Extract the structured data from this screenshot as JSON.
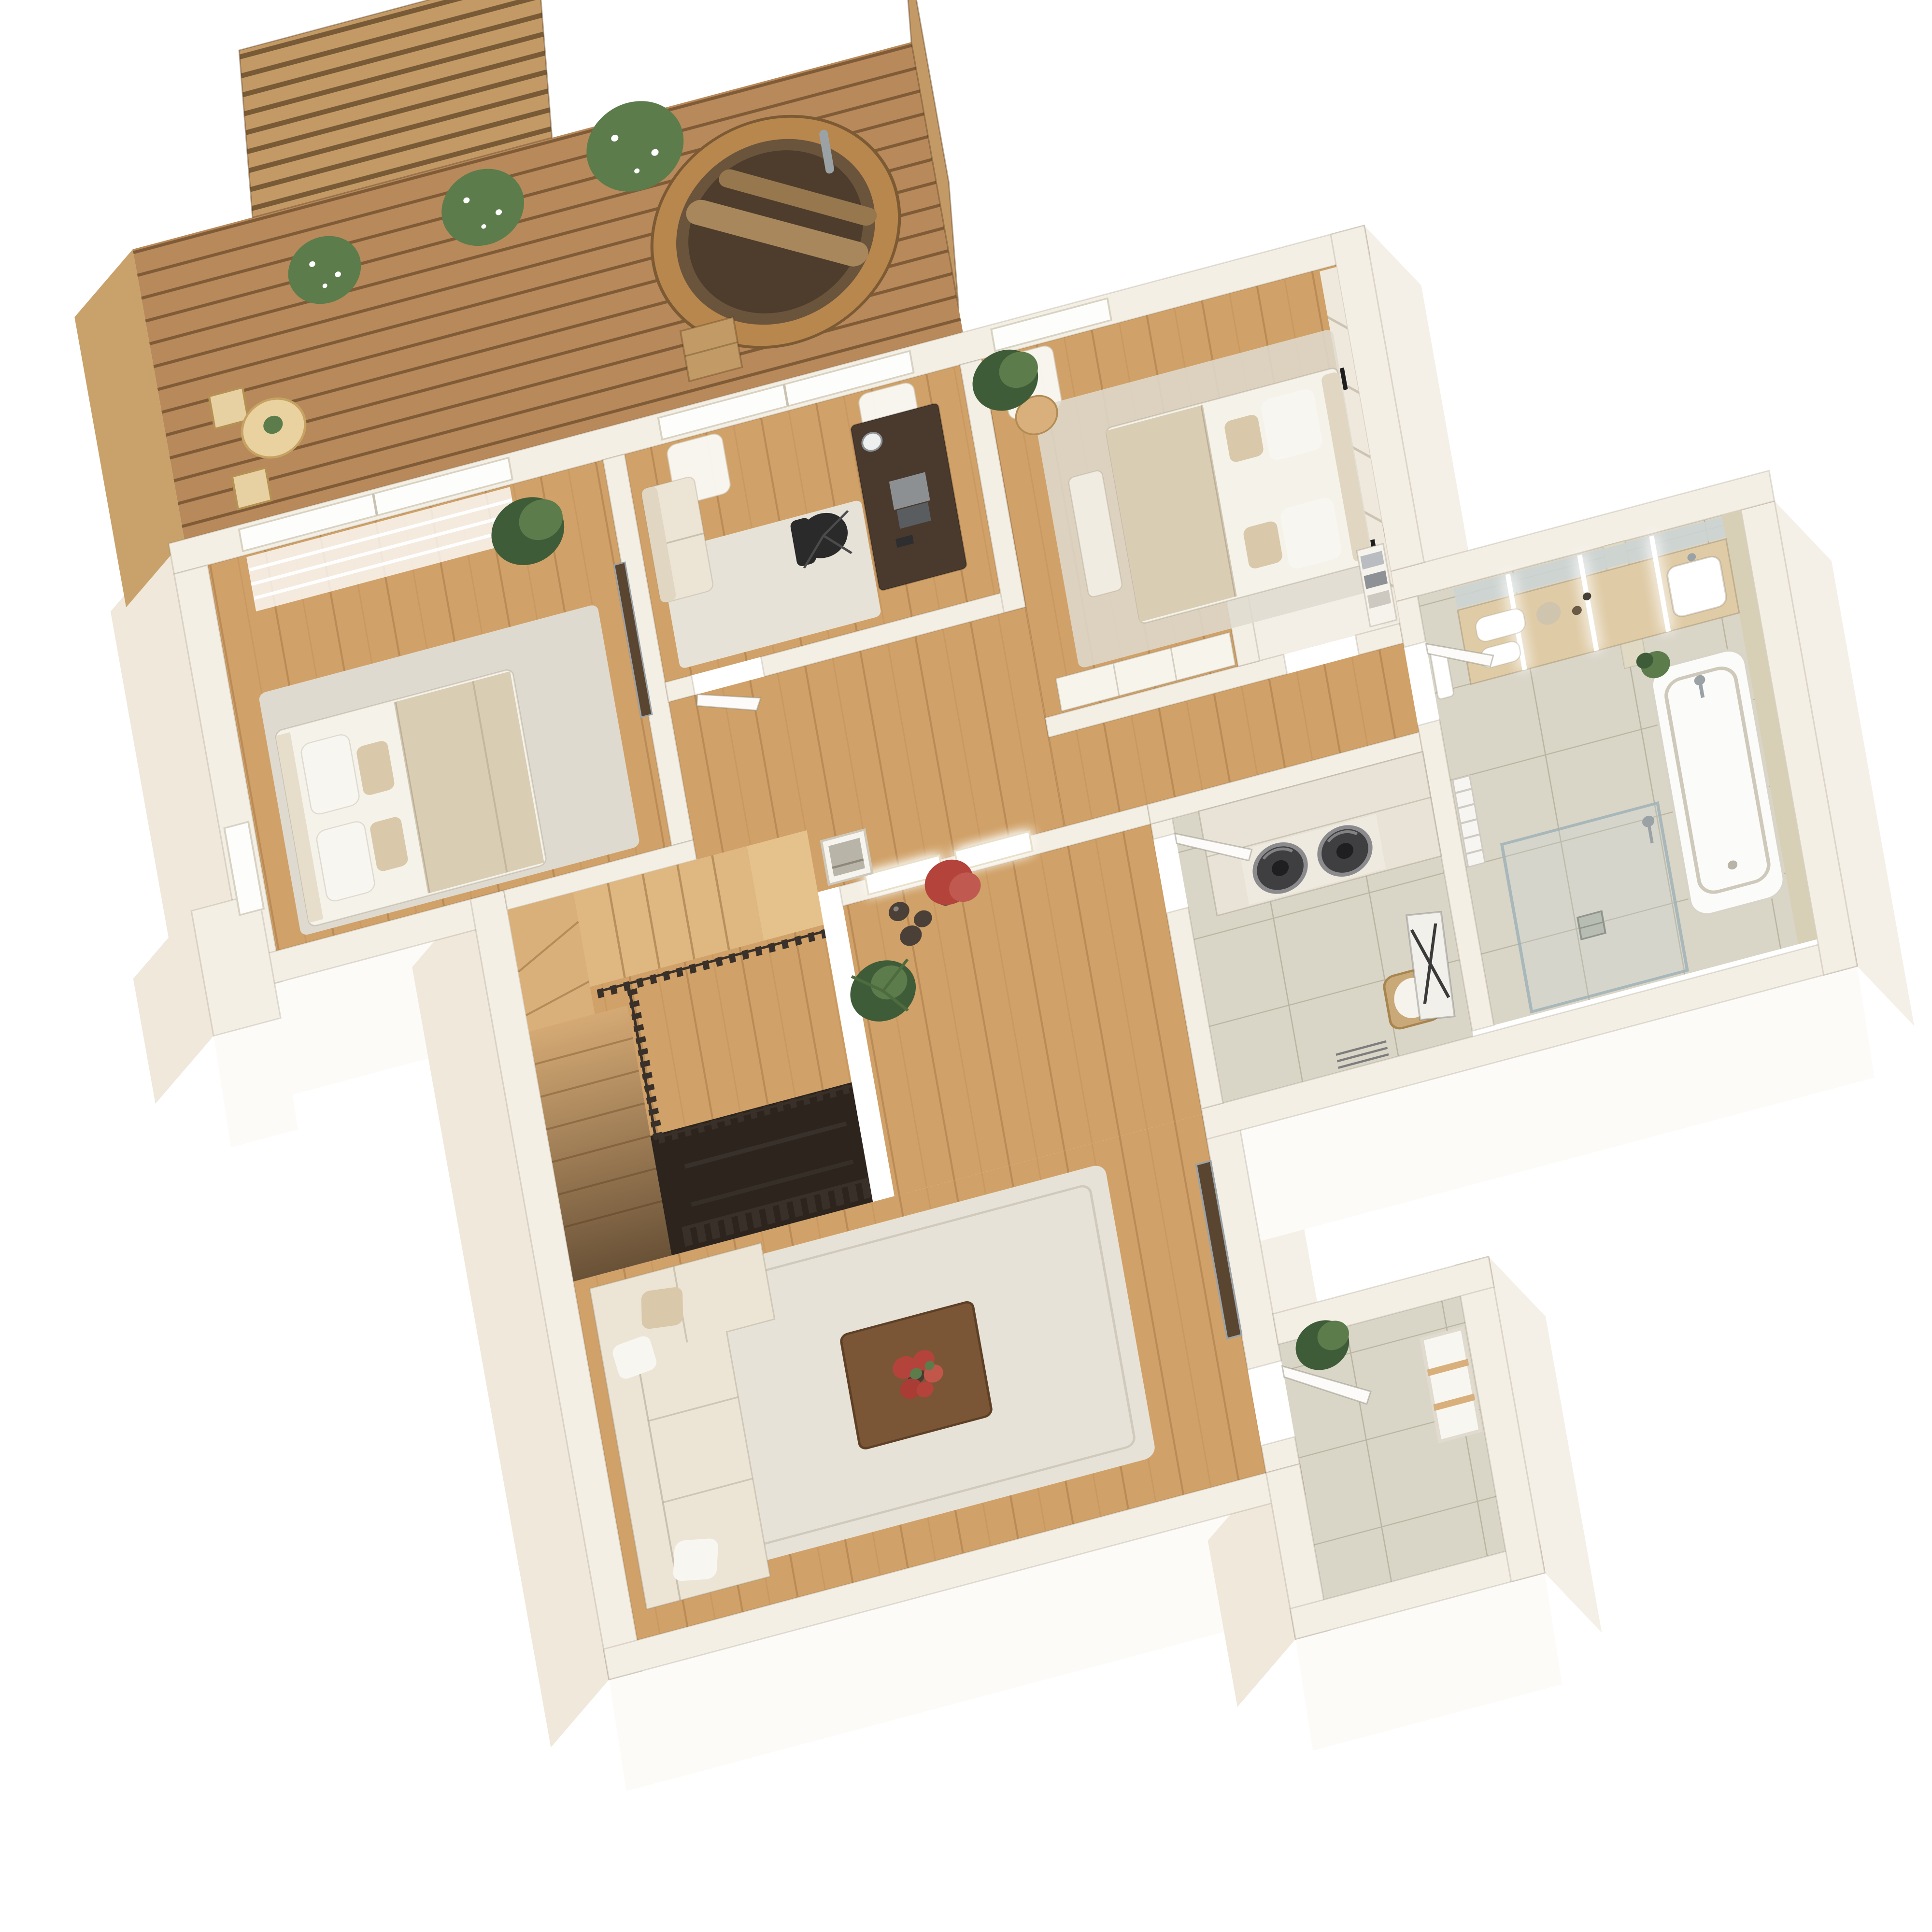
{
  "scene": {
    "type": "3d-floor-plan-render",
    "view": "axonometric top-down, plan rotated ~15 degrees, white background",
    "style": "soft minimalist cream walls with light oak flooring and wooden roof terrace"
  },
  "palette": {
    "bg": "#ffffff",
    "wallTop": "#f4efe5",
    "faceBright": "#fcfbf8",
    "faceLight": "#f5f0e7",
    "faceShade": "#efe8db",
    "deckWood": "#b8895a",
    "deckEdge": "#c9a26b",
    "screenWood": "#c39a66",
    "floorWood": "#d0a168",
    "tile": "#d9d5c7",
    "stone": "#d7cfb6",
    "railDark": "#39302a",
    "sofa": "#ece5d5",
    "cushion": "#e0d6c1",
    "pillowWhite": "#f8f6f1",
    "pillowBeige": "#d9c8a9",
    "bedLinen": "#f5f2ea",
    "blanket": "#d9cdb4",
    "rugLight": "#e7e2d7",
    "rugBedroom": "#dfdacf",
    "desk": "#4a3a2e",
    "chairBlack": "#2a2a2a",
    "tableWalnut": "#7a5636",
    "tvPanel": "#5a4531",
    "flowersRed": "#b4433c",
    "plantGreen": "#5c7c4c",
    "plantDark": "#3f5c38",
    "potGrey": "#8f8f8c",
    "potDark": "#4b4038",
    "counter": "#dfcba6",
    "mirror": "#ccd4d2",
    "chrome": "#9aa2a6",
    "tubWhite": "#fbfbf9",
    "applianceDark": "#3f3f41",
    "cabinet": "#e9e3d7",
    "basket": "#c9a978",
    "woodLight": "#d9b07c",
    "stairDark": "#2c241d",
    "doorWhite": "#fcfbf9",
    "glass": "#c7d3d6"
  },
  "rooms": [
    {
      "id": "terrace",
      "name": "Roof terrace",
      "floor": "wood decking",
      "items": [
        "slatted privacy screen left",
        "slatted privacy screen right",
        "cedar hot tub",
        "hot tub step ladder",
        "bistro table",
        "folding chair x2",
        "table plant",
        "potted boxwood in grey pot x3"
      ]
    },
    {
      "id": "bedroom-2",
      "name": "Second bedroom",
      "floor": "oak",
      "items": [
        "double bed with white linen and beige throw",
        "pillows x4",
        "area rug",
        "potted plant",
        "wall-mounted tv panel",
        "sheer roller blind window",
        "side window"
      ]
    },
    {
      "id": "home-office",
      "name": "Home office",
      "floor": "oak",
      "items": [
        "dark wood desk",
        "open laptop",
        "desk lamp",
        "black office chair",
        "beige loveseat",
        "area rug",
        "sliding glass door with curtains"
      ]
    },
    {
      "id": "master-bedroom",
      "name": "Master bedroom",
      "floor": "oak",
      "items": [
        "upholstered bed with beige headboard",
        "white and beige pillows",
        "beige throw",
        "textured accent wall",
        "wall sconce light x2",
        "round side table",
        "potted plant",
        "foot bench",
        "white wardrobe",
        "rug",
        "sliding glass door with curtain"
      ]
    },
    {
      "id": "walk-in-closet",
      "name": "Walk-in closet",
      "floor": "cream",
      "items": [
        "open shelving with folded linens"
      ]
    },
    {
      "id": "hallway",
      "name": "Hallway landing",
      "floor": "oak",
      "items": [
        "backlit relief art panel x2",
        "leaning framed print",
        "decorative vase x3",
        "red japanese maple plant",
        "yucca plant"
      ]
    },
    {
      "id": "staircase",
      "name": "Staircase",
      "floor": "oak treads",
      "items": [
        "upper flight",
        "winder corner",
        "lower flight",
        "dark slatted balustrade",
        "stair void to lower level",
        "slatted guard screen"
      ]
    },
    {
      "id": "laundry-room",
      "name": "Laundry room",
      "floor": "tile",
      "items": [
        "built-in cabinet with stacked washer and dryer",
        "wicker laundry basket with liner",
        "wall ironing board",
        "drying rack",
        "open door"
      ]
    },
    {
      "id": "bathroom",
      "name": "Bathroom",
      "floor": "tile",
      "items": [
        "double vanity counter",
        "mirror with led strip x3",
        "rolled towels",
        "perfume tray",
        "wall towel",
        "heated towel radiator",
        "bathtub with chrome faucet",
        "stone accent wall",
        "glass walk-in shower",
        "floor drain",
        "small plant"
      ]
    },
    {
      "id": "living-room",
      "name": "Living room",
      "floor": "oak",
      "items": [
        "l-shaped beige sectional sofa",
        "throw pillows",
        "cream area rug",
        "walnut coffee table",
        "red flower centerpiece",
        "wall-mounted walnut tv panel",
        "doorway to entry"
      ]
    },
    {
      "id": "entry-hall",
      "name": "Entry hall",
      "floor": "tile",
      "items": [
        "open white entry door",
        "fiddle leaf plant",
        "shoe rack bench with wood shelves"
      ]
    }
  ]
}
